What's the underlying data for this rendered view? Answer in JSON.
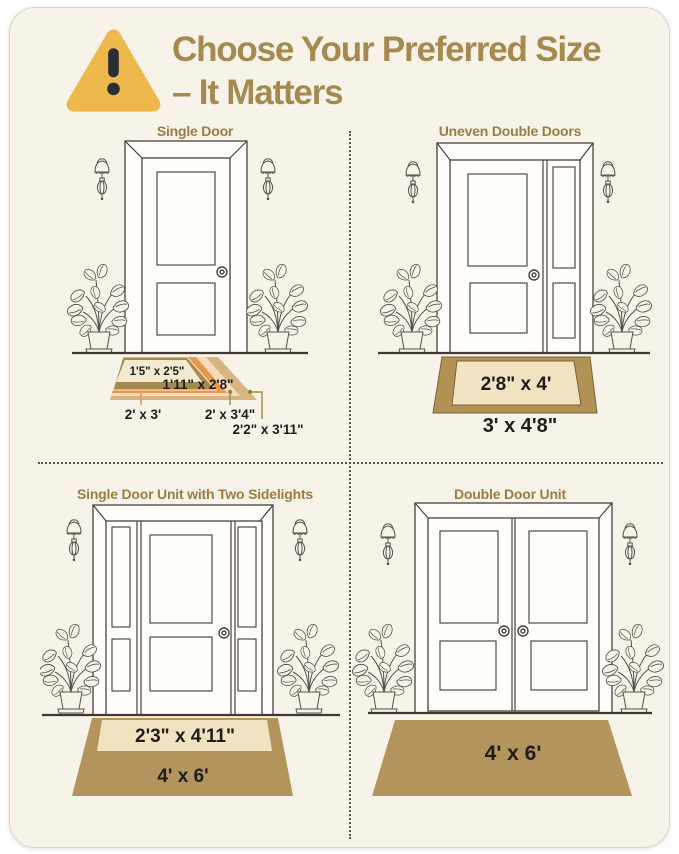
{
  "page": {
    "background": "#ffffff",
    "card_background": "#f8f3e9"
  },
  "header": {
    "icon": "warning-triangle",
    "icon_color": "#edb94d",
    "exclamation_color": "#2c2e35",
    "title_line1": "Choose Your Preferred Size",
    "title_line2": "– It Matters",
    "title_color": "#a6894f"
  },
  "quadrants": [
    {
      "id": "single-door",
      "title": "Single Door",
      "mats": [
        {
          "size": "1'5\" x 2'5\"",
          "color": "#f3ead2"
        },
        {
          "size": "1'11\" x 2'8\"",
          "color": "#a48a50"
        },
        {
          "size": "2' x 3'",
          "color": "#e8964e"
        },
        {
          "size": "2' x 3'4\"",
          "color": "#f6dcba"
        },
        {
          "size": "2'2\" x 3'11\"",
          "color": "#d6b582"
        }
      ]
    },
    {
      "id": "uneven-double-doors",
      "title": "Uneven Double Doors",
      "mats": [
        {
          "size": "2'8\" x 4'",
          "color": "#f1e3c2"
        },
        {
          "size": "3' x 4'8\"",
          "color": "#b29254"
        }
      ]
    },
    {
      "id": "single-door-two-sidelights",
      "title": "Single Door Unit with Two Sidelights",
      "mats": [
        {
          "size": "2'3\" x 4'11\"",
          "color": "#f1e3c2"
        },
        {
          "size": "4' x 6'",
          "color": "#b3945c"
        }
      ]
    },
    {
      "id": "double-door-unit",
      "title": "Double Door Unit",
      "mats": [
        {
          "size": "4' x 6'",
          "color": "#b3945c"
        }
      ]
    }
  ]
}
